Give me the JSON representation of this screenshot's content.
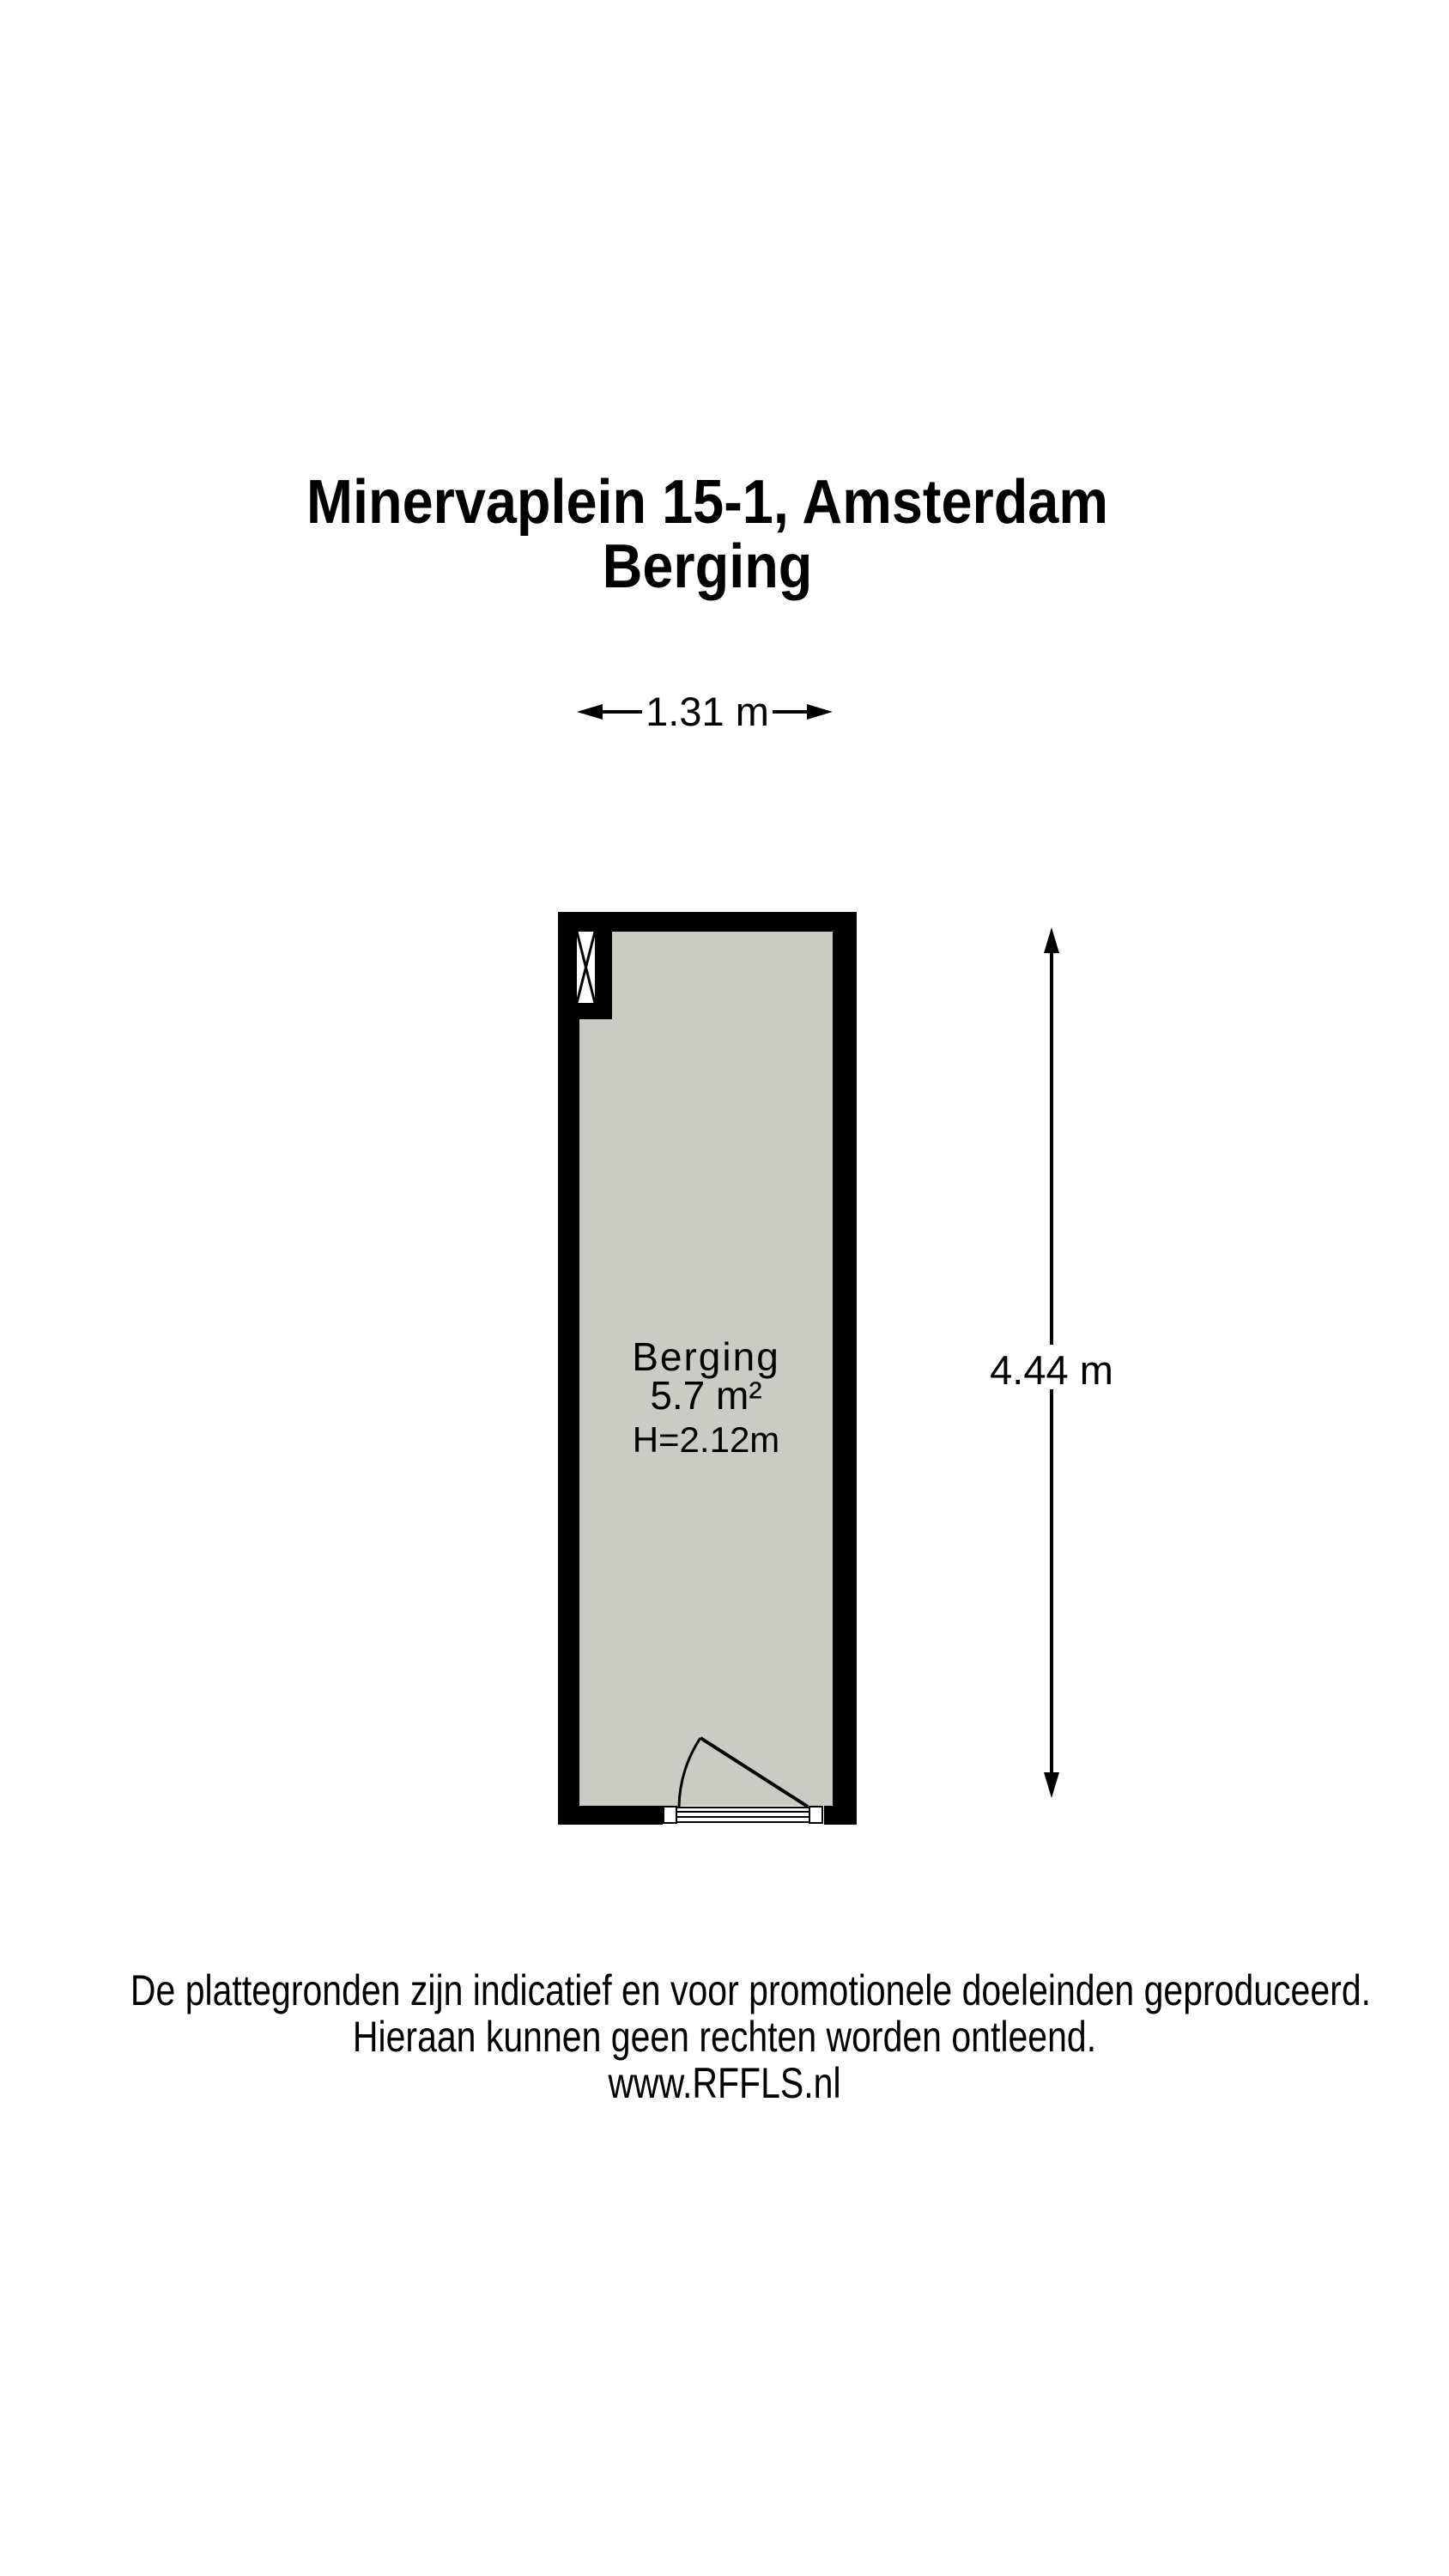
{
  "title": {
    "line1": "Minervaplein 15-1, Amsterdam",
    "line2": "Berging"
  },
  "dimensions": {
    "width_label": "1.31 m",
    "height_label": "4.44 m"
  },
  "room": {
    "name": "Berging",
    "area": "5.7 m²",
    "ceiling_height": "H=2.12m"
  },
  "footer": {
    "line1": "De plattegronden zijn indicatief en voor promotionele doeleinden geproduceerd.",
    "line2": "Hieraan kunnen geen rechten worden ontleend.",
    "line3": "www.RFFLS.nl"
  },
  "colors": {
    "wall": "#000000",
    "floor": "#cbcbc5",
    "background": "#ffffff",
    "line": "#000000"
  }
}
